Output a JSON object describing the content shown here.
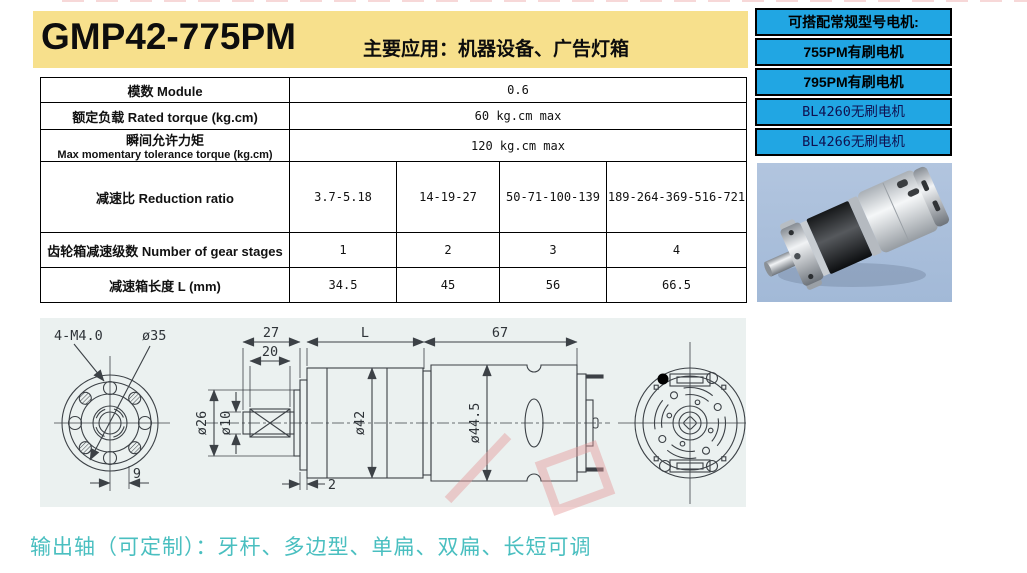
{
  "header": {
    "title": "GMP42-775PM",
    "subtitle": "主要应用：机器设备、广告灯箱"
  },
  "sidebar": {
    "title": "可搭配常规型号电机:",
    "items": [
      "755PM有刷电机",
      "795PM有刷电机",
      "BL4260无刷电机",
      "BL4266无刷电机"
    ]
  },
  "spec_table": {
    "rows": [
      {
        "label": "模数 Module",
        "value": "0.6"
      },
      {
        "label": "额定负载 Rated torque (kg.cm)",
        "value": "60 kg.cm max"
      },
      {
        "label_cn": "瞬间允许力矩",
        "label_en": "Max momentary tolerance torque (kg.cm)",
        "value": "120 kg.cm max"
      },
      {
        "label": "减速比 Reduction ratio",
        "values": [
          "3.7-5.18",
          "14-19-27",
          "50-71-100-139",
          "189-264-369-516-721"
        ]
      },
      {
        "label": "齿轮箱减速级数 Number of gear stages",
        "values": [
          "1",
          "2",
          "3",
          "4"
        ]
      },
      {
        "label": "减速箱长度 L (mm)",
        "values": [
          "34.5",
          "45",
          "56",
          "66.5"
        ]
      }
    ]
  },
  "drawing": {
    "front_view": {
      "bolt_label": "4-M4.0",
      "dia_label": "ø35",
      "offset_label": "9"
    },
    "side_view": {
      "shaft_len": "27",
      "key_len": "20",
      "collar_dia": "ø26",
      "shaft_dia": "ø10",
      "plate_thk": "2",
      "gearbox_len": "L",
      "gearbox_dia": "ø42",
      "motor_len": "67",
      "motor_dia": "ø44.5"
    }
  },
  "footer": {
    "note": "输出轴（可定制）：牙杆、多边型、单扁、双扁、长短可调"
  },
  "colors": {
    "header_bg": "#F7E08C",
    "box_blue": "#21A6E3",
    "photo_bg": "#A9BFDB",
    "drawing_bg": "#EBF1F0",
    "line": "#3C4146",
    "accent_teal": "#4ABFC0",
    "watermark_pink": "#E59A9A"
  }
}
